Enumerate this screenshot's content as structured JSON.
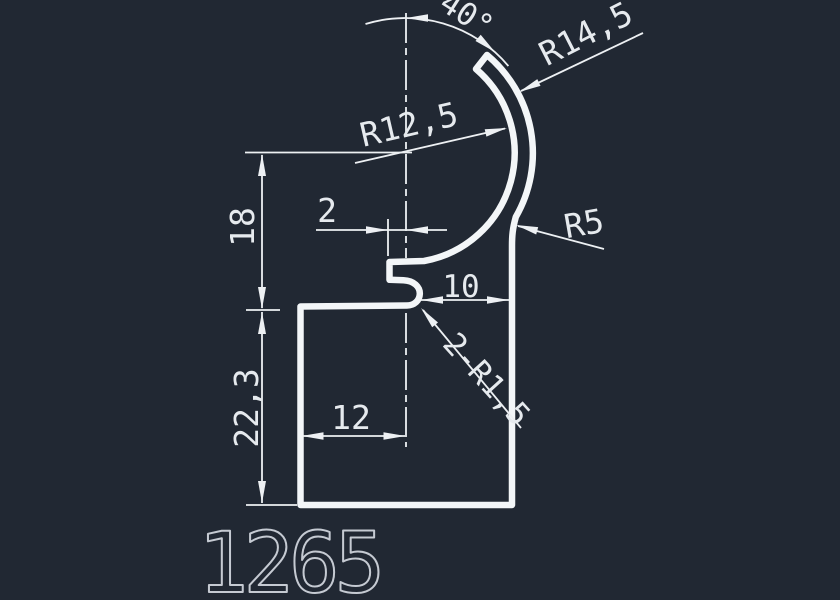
{
  "drawing": {
    "part_number": "1265",
    "labels": {
      "angle": "40°",
      "outer_radius": "R14,5",
      "inner_radius": "R12,5",
      "fillet_radius": "R5",
      "wall_offset": "2",
      "upper_height": "18",
      "slot_width": "10",
      "lip_fillets": "2-R1,5",
      "lower_height": "22,3",
      "base_width": "12"
    },
    "colors": {
      "background": "#212833",
      "line": "#edf0f3",
      "profile": "#f3f6f8",
      "text": "#e6eaee",
      "part_number_color": "#c5cad2"
    }
  }
}
